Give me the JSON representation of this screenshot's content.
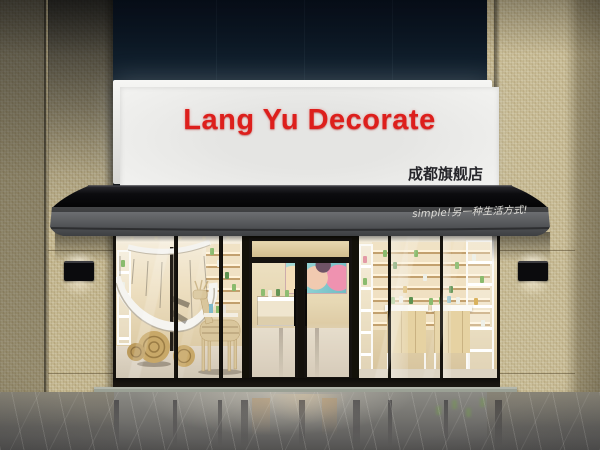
{
  "sign": {
    "title": "Lang Yu Decorate",
    "subtitle": "成都旗舰店",
    "colors": {
      "title": "#dd1f1c",
      "subtitle": "#26262b",
      "panel": "#f0f0ee",
      "frame": "#e7e7e5"
    }
  },
  "awning": {
    "slogan": "simple!另一种生活方式!",
    "colors": {
      "canopy": "#121216",
      "fascia": "#55585a",
      "slogan": "#eceae4"
    }
  },
  "facade": {
    "colors": {
      "upper_panel": "#0e1b28",
      "tile": "#c6ba94",
      "frame": "#17140f",
      "transom_wood": "#d9c69c"
    }
  },
  "interior": {
    "colors": {
      "wall": "#e9dcbf",
      "staircase": "#f3f2ee",
      "product_green": "#8abb6e",
      "deer_wood": "#d9c69c"
    }
  },
  "floor": {
    "colors": {
      "marble": "#7e7d78",
      "threshold": "#8f948a"
    }
  }
}
